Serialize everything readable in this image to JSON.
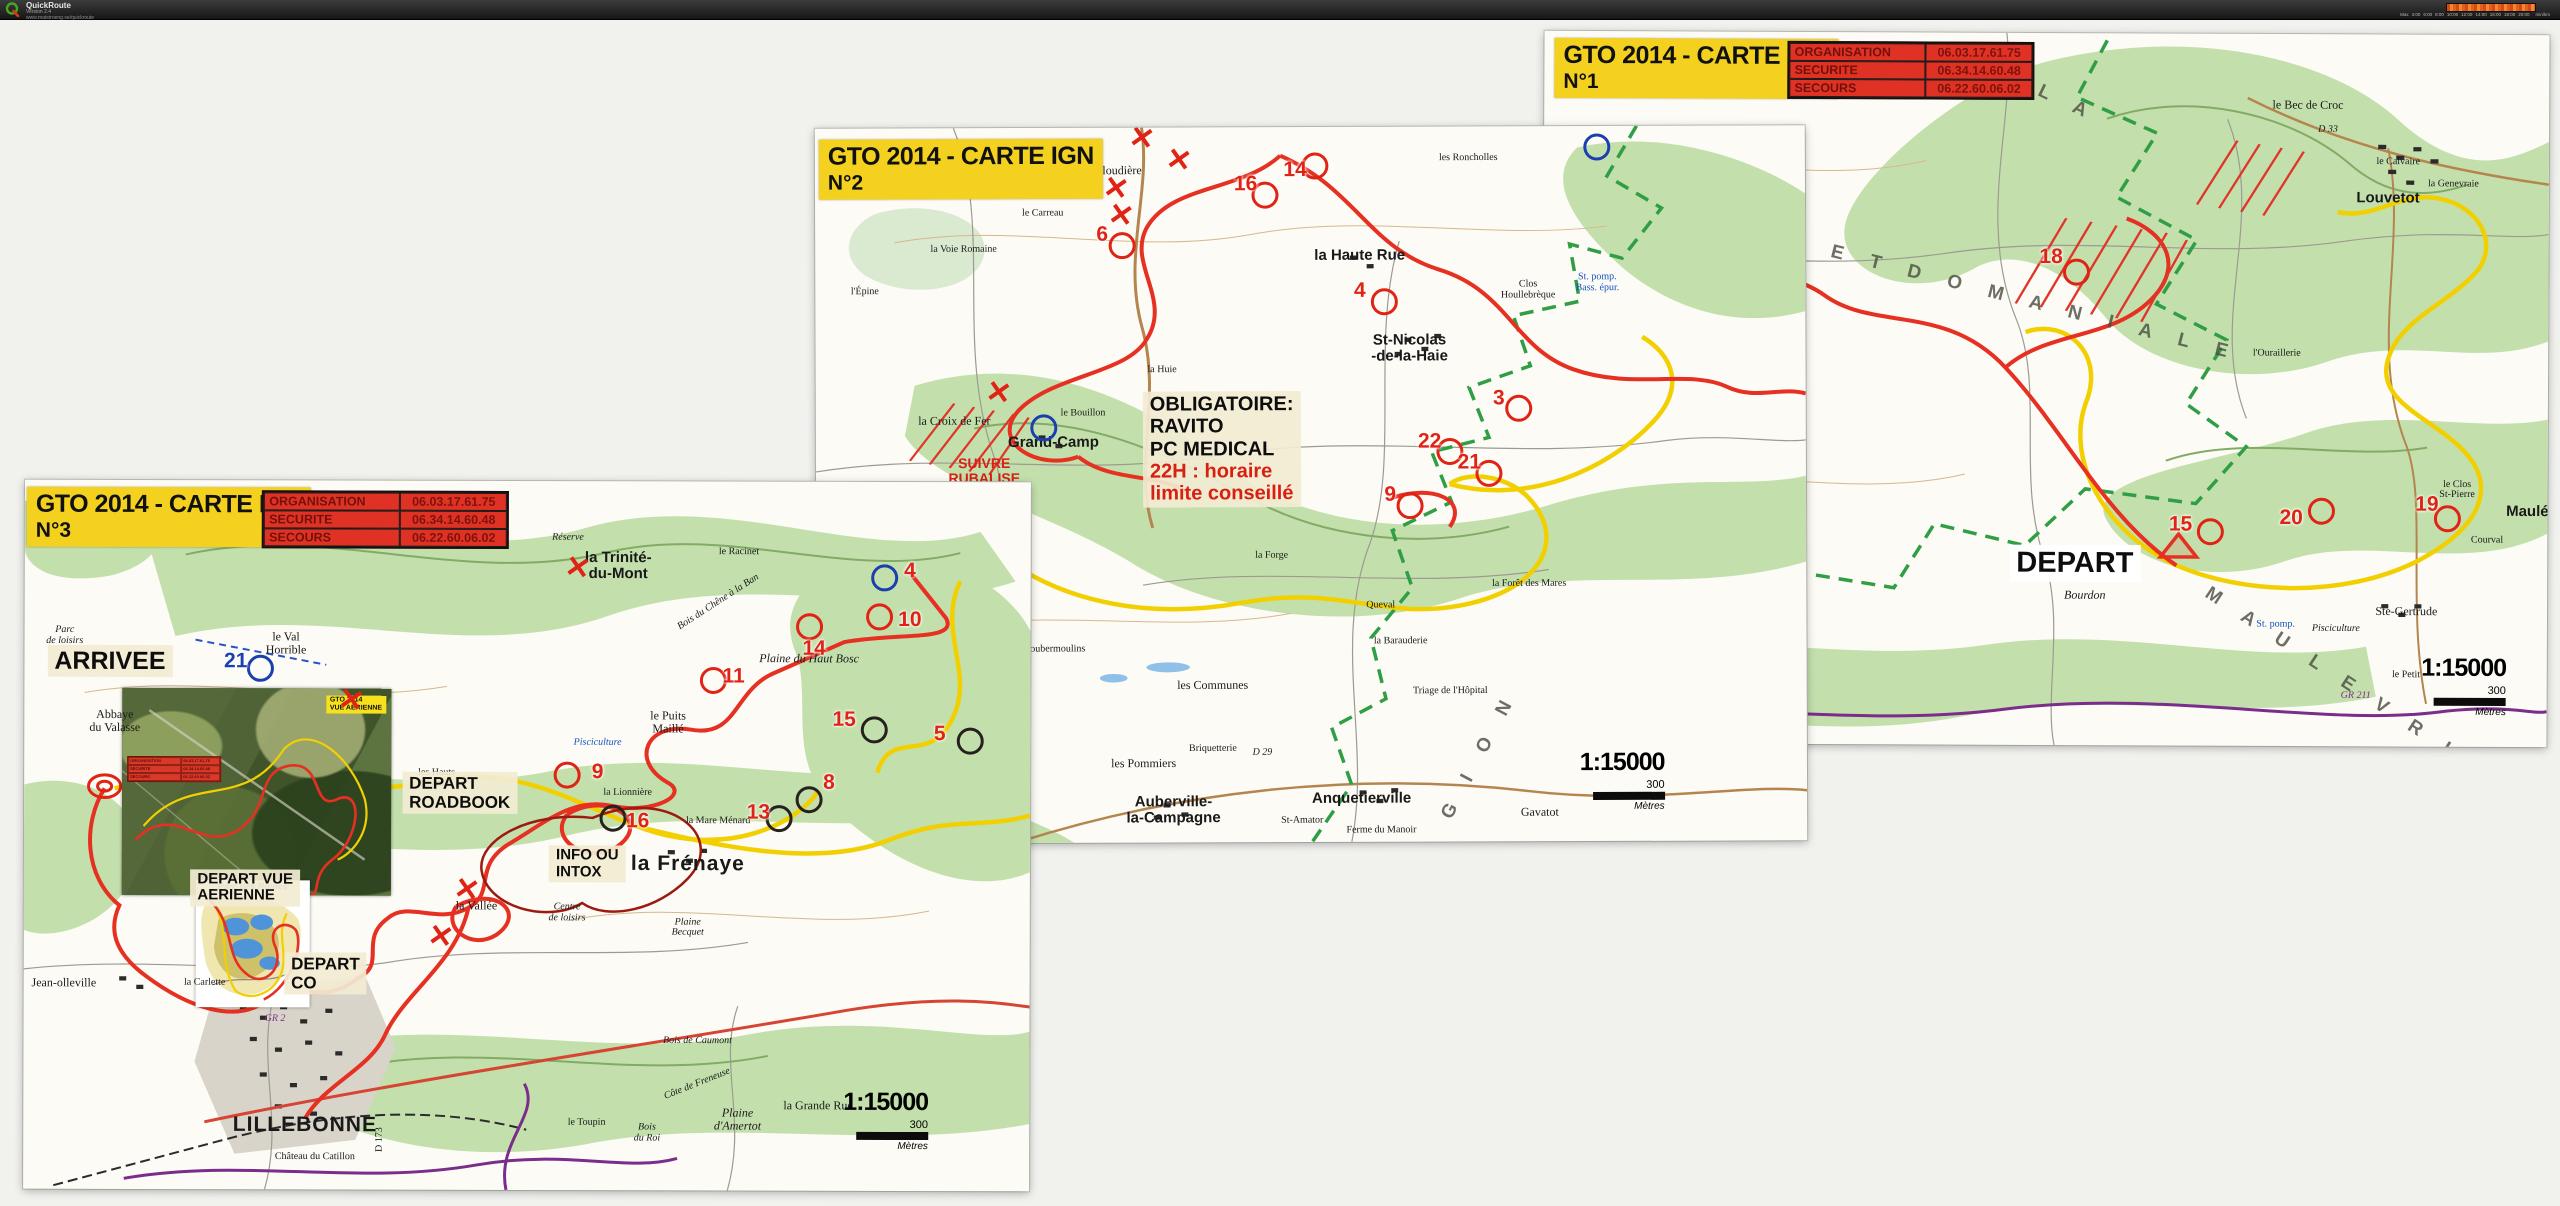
{
  "toolbar": {
    "app_name": "QuickRoute",
    "version": "Version 2.4",
    "url": "www.matstroeng.se/quickroute",
    "legend": {
      "ticks": [
        "Max",
        "4:00",
        "6:00",
        "8:00",
        "10:00",
        "12:00",
        "14:00",
        "16:00",
        "18:00",
        "20:00"
      ],
      "unit": "min/km"
    }
  },
  "colors": {
    "route_red": "#e53022",
    "route_yellow": "#f2cf00",
    "gr_purple": "#7b2d8b",
    "pnr_green": "#2f9e44",
    "title_yellow": "#f4d11f",
    "table_red": "#e03224"
  },
  "sheets": [
    {
      "id": "carte-n1",
      "title": [
        "GTO 2014 - CARTE IGN",
        "N°1"
      ],
      "contacts": [
        [
          "ORGANISATION",
          "06.03.17.61.75"
        ],
        [
          "SECURITE",
          "06.34.14.60.48"
        ],
        [
          "SECOURS",
          "06.22.60.06.02"
        ]
      ],
      "scale": {
        "ratio": "1:15000",
        "value": "300",
        "unit": "Mètres"
      },
      "annotations": [
        {
          "x": 53,
          "y": 74.5,
          "variant": "white",
          "size": 29,
          "lines": [
            {
              "t": "DEPART"
            }
          ]
        }
      ],
      "places": [
        {
          "t": "St-Aubin-\n-de-Crétot",
          "x": 4.5,
          "y": 17,
          "cls": "big"
        },
        {
          "t": "Haut Hôtel",
          "x": 14,
          "y": 23,
          "cls": "tiny"
        },
        {
          "t": "la Cahennerie",
          "x": 8,
          "y": 28,
          "cls": "tiny"
        },
        {
          "t": "le Pommeret",
          "x": 8.5,
          "y": 33,
          "cls": "tiny"
        },
        {
          "t": "St-Gilles-\n-de-Crétot",
          "x": 13,
          "y": 39,
          "cls": "big"
        },
        {
          "t": "Coquetot",
          "x": 20,
          "y": 34,
          "cls": "tiny it"
        },
        {
          "t": "Louvetot",
          "x": 84,
          "y": 23,
          "cls": "big"
        },
        {
          "t": "le Bec de Croc",
          "x": 76,
          "y": 10
        },
        {
          "t": "D 33",
          "x": 78,
          "y": 13.5,
          "cls": "tiny it"
        },
        {
          "t": "le Calvaire",
          "x": 85,
          "y": 18,
          "cls": "tiny"
        },
        {
          "t": "la Genevraie",
          "x": 90.5,
          "y": 21,
          "cls": "tiny"
        },
        {
          "t": "l'Ouraillerie",
          "x": 73,
          "y": 45,
          "cls": "tiny"
        },
        {
          "t": "le Clos\nSt-Pierre",
          "x": 91,
          "y": 64,
          "cls": "tiny"
        },
        {
          "t": "Maulé",
          "x": 98,
          "y": 67,
          "cls": "big"
        },
        {
          "t": "Courval",
          "x": 94,
          "y": 71,
          "cls": "tiny"
        },
        {
          "t": "Ste-Gertrude",
          "x": 86,
          "y": 81
        },
        {
          "t": "Pisciculture",
          "x": 79,
          "y": 83.5,
          "cls": "tiny it"
        },
        {
          "t": "le Petit",
          "x": 86,
          "y": 90,
          "cls": "tiny"
        },
        {
          "t": "GR 211",
          "x": 81,
          "y": 93,
          "cls": "tiny it purple"
        },
        {
          "t": "Bourdon",
          "x": 54,
          "y": 79,
          "cls": "it"
        },
        {
          "t": "St. pomp.",
          "x": 73,
          "y": 83,
          "cls": "tiny blue"
        },
        {
          "t": "F O R E T   D O M A N I A L E",
          "x": 43,
          "y": 36,
          "cls": "spread",
          "rot": 14
        },
        {
          "t": "B O U C L E S",
          "x": 9,
          "y": 56,
          "cls": "spread",
          "rot": 78
        },
        {
          "t": "D E S",
          "x": 16,
          "y": 77,
          "cls": "spread",
          "rot": 55
        },
        {
          "t": "L A",
          "x": 52,
          "y": 10,
          "cls": "spread",
          "rot": 25
        },
        {
          "t": "M A U L E V R I E R",
          "x": 82,
          "y": 93,
          "cls": "spread",
          "rot": 33
        }
      ],
      "controls": [
        {
          "n": "15",
          "tx": 63.5,
          "ty": 69,
          "cx": 66.5,
          "cy": 70
        },
        {
          "n": "18",
          "tx": 50.5,
          "ty": 31.5,
          "cx": 53,
          "cy": 33.5
        },
        {
          "n": "19",
          "tx": 88,
          "ty": 66,
          "cx": 90,
          "cy": 68
        },
        {
          "n": "20",
          "tx": 74.5,
          "ty": 68,
          "cx": 77.5,
          "cy": 67
        },
        {
          "n": "22",
          "tx": 20,
          "ty": 51,
          "cx": 22.5,
          "cy": 52.5
        }
      ],
      "xmarks": []
    },
    {
      "id": "carte-n2",
      "title": [
        "GTO 2014 - CARTE IGN",
        "N°2"
      ],
      "contacts": [],
      "scale": {
        "ratio": "1:15000",
        "value": "300",
        "unit": "Mètres"
      },
      "annotations": [
        {
          "x": 41,
          "y": 45,
          "variant": "beige",
          "size": 20,
          "lines": [
            {
              "t": "OBLIGATOIRE:"
            },
            {
              "t": "RAVITO"
            },
            {
              "t": "PC MEDICAL"
            },
            {
              "t": "22H : horaire",
              "red": true
            },
            {
              "t": "limite conseillé",
              "red": true
            }
          ]
        }
      ],
      "places": [
        {
          "t": "la Gloudière",
          "x": 30,
          "y": 6
        },
        {
          "t": "les Sureaux",
          "x": 10,
          "y": 3.5,
          "cls": "tiny it"
        },
        {
          "t": "le Mare Cardot",
          "x": 21,
          "y": 8.5,
          "cls": "tiny"
        },
        {
          "t": "le Carreau",
          "x": 23,
          "y": 12,
          "cls": "tiny"
        },
        {
          "t": "la Voie Romaine",
          "x": 15,
          "y": 17,
          "cls": "tiny"
        },
        {
          "t": "l'Épine",
          "x": 5,
          "y": 23,
          "cls": "tiny"
        },
        {
          "t": "le Bouillon",
          "x": 27,
          "y": 40,
          "cls": "tiny"
        },
        {
          "t": "Grand-Camp",
          "x": 24,
          "y": 44,
          "cls": "big"
        },
        {
          "t": "la Croix de Fer",
          "x": 14,
          "y": 41
        },
        {
          "t": "SUIVRE\nRUBALISE",
          "x": 17,
          "y": 48,
          "cls": "red"
        },
        {
          "t": "la Huie",
          "x": 35,
          "y": 34,
          "cls": "tiny"
        },
        {
          "t": "St-Nicolas\n-de-la-Haie",
          "x": 60,
          "y": 31,
          "cls": "big"
        },
        {
          "t": "la Haute Rue",
          "x": 55,
          "y": 18,
          "cls": "big"
        },
        {
          "t": "les Roncholles",
          "x": 66,
          "y": 4.5,
          "cls": "tiny"
        },
        {
          "t": "Clos\nHoullebrèque",
          "x": 72,
          "y": 23,
          "cls": "tiny"
        },
        {
          "t": "St. pomp.\nBass. épur.",
          "x": 79,
          "y": 22,
          "cls": "tiny blue"
        },
        {
          "t": "les Communes",
          "x": 40,
          "y": 78
        },
        {
          "t": "la Nouette",
          "x": 17,
          "y": 68,
          "cls": "tiny"
        },
        {
          "t": "Goubermoulins",
          "x": 24,
          "y": 73,
          "cls": "tiny"
        },
        {
          "t": "la Forge",
          "x": 46,
          "y": 60,
          "cls": "tiny"
        },
        {
          "t": "Queval",
          "x": 57,
          "y": 67,
          "cls": "tiny"
        },
        {
          "t": "la Barauderie",
          "x": 59,
          "y": 72,
          "cls": "tiny"
        },
        {
          "t": "Triage de l'Hôpital",
          "x": 64,
          "y": 79,
          "cls": "tiny"
        },
        {
          "t": "la Forêt des Mares",
          "x": 72,
          "y": 64,
          "cls": "tiny"
        },
        {
          "t": "les Pommiers",
          "x": 33,
          "y": 89
        },
        {
          "t": "Auberville-\nla-Campagne",
          "x": 36,
          "y": 95.5,
          "cls": "big"
        },
        {
          "t": "St-Amator",
          "x": 49,
          "y": 97,
          "cls": "tiny"
        },
        {
          "t": "Anquetierville",
          "x": 55,
          "y": 94,
          "cls": "big"
        },
        {
          "t": "Ferme du Manoir",
          "x": 57,
          "y": 98.5,
          "cls": "tiny"
        },
        {
          "t": "Gavatot",
          "x": 73,
          "y": 96
        },
        {
          "t": "Briquetterie",
          "x": 40,
          "y": 87,
          "cls": "tiny"
        },
        {
          "t": "D 29",
          "x": 45,
          "y": 87.5,
          "cls": "tiny it"
        },
        {
          "t": "G I O N",
          "x": 67,
          "y": 88,
          "cls": "spread",
          "rot": -62
        }
      ],
      "controls": [
        {
          "n": "14",
          "tx": 48.5,
          "ty": 6,
          "cx": 50.5,
          "cy": 5.5
        },
        {
          "n": "16",
          "tx": 43.5,
          "ty": 8,
          "cx": 45.5,
          "cy": 9.5
        },
        {
          "n": "6",
          "tx": 29,
          "ty": 15,
          "cx": 31,
          "cy": 16.5
        },
        {
          "n": "4",
          "tx": 55,
          "ty": 23,
          "cx": 57.5,
          "cy": 24.5
        },
        {
          "n": "3",
          "tx": 69,
          "ty": 38,
          "cx": 71,
          "cy": 39.5
        },
        {
          "n": "22",
          "tx": 62,
          "ty": 44,
          "cx": 64,
          "cy": 45.5
        },
        {
          "n": "21",
          "tx": 66,
          "ty": 47,
          "cx": 68,
          "cy": 48.5
        },
        {
          "n": "9",
          "tx": 58,
          "ty": 51.5,
          "cx": 60,
          "cy": 53
        },
        {
          "n": "2",
          "tx": 14,
          "ty": 53,
          "cx": 16,
          "cy": 55
        },
        {
          "n": "",
          "cx": 23,
          "cy": 42,
          "rc": "blue"
        },
        {
          "n": "",
          "cx": 79,
          "cy": 3,
          "rc": "blue"
        }
      ],
      "xmarks": [
        {
          "x": 36.8,
          "y": 4.6
        },
        {
          "x": 33,
          "y": 1.5
        },
        {
          "x": 30.4,
          "y": 8.5
        },
        {
          "x": 30.9,
          "y": 12.3
        },
        {
          "x": 18.5,
          "y": 37
        }
      ]
    },
    {
      "id": "carte-n3",
      "title": [
        "GTO 2014 - CARTE IGN",
        "N°3"
      ],
      "contacts": [
        [
          "ORGANISATION",
          "06.03.17.61.75"
        ],
        [
          "SECURITE",
          "06.34.14.60.48"
        ],
        [
          "SECOURS",
          "06.22.60.06.02"
        ]
      ],
      "scale": {
        "ratio": "1:15000",
        "value": "300",
        "unit": "Mètres"
      },
      "aerial": {
        "label": [
          "GTO 2014",
          "VUE AERIENNE"
        ]
      },
      "omap": {
        "title": "Parc des Ruines"
      },
      "annotations": [
        {
          "x": 8.5,
          "y": 25.5,
          "variant": "beige",
          "size": 25,
          "lines": [
            {
              "t": "ARRIVEE"
            }
          ]
        },
        {
          "x": 43.3,
          "y": 44,
          "variant": "beige",
          "size": 17,
          "lines": [
            {
              "t": "DEPART"
            },
            {
              "t": "ROADBOOK"
            }
          ]
        },
        {
          "x": 56,
          "y": 54,
          "variant": "beige",
          "size": 15,
          "lines": [
            {
              "t": "INFO OU"
            },
            {
              "t": "INTOX"
            }
          ]
        },
        {
          "x": 22,
          "y": 57.5,
          "variant": "beige",
          "size": 15,
          "lines": [
            {
              "t": "DEPART VUE"
            },
            {
              "t": "AERIENNE"
            }
          ]
        },
        {
          "x": 30,
          "y": 69.5,
          "variant": "beige",
          "size": 17,
          "lines": [
            {
              "t": "DEPART"
            },
            {
              "t": "CO"
            }
          ]
        }
      ],
      "places": [
        {
          "t": "la Trinité-\ndu-Mont",
          "x": 59,
          "y": 12,
          "cls": "big"
        },
        {
          "t": "le Racinet",
          "x": 71,
          "y": 10,
          "cls": "tiny"
        },
        {
          "t": "Réserve",
          "x": 54,
          "y": 8,
          "cls": "tiny it"
        },
        {
          "t": "Plaine du Haut Bosc",
          "x": 78,
          "y": 25,
          "cls": "it"
        },
        {
          "t": "Bois du Chêne à la Ban",
          "x": 69,
          "y": 17,
          "cls": "it tiny",
          "rot": -33
        },
        {
          "t": "le Puits\nMaillé",
          "x": 64,
          "y": 34
        },
        {
          "t": "la Lionnière",
          "x": 60,
          "y": 44,
          "cls": "tiny"
        },
        {
          "t": "la Mare Ménard",
          "x": 69,
          "y": 48,
          "cls": "tiny"
        },
        {
          "t": "Pisciculture",
          "x": 57,
          "y": 37,
          "cls": "tiny it blue"
        },
        {
          "t": "Abbaye\ndu Valasse",
          "x": 9,
          "y": 34
        },
        {
          "t": "Parc\nde loisirs",
          "x": 4,
          "y": 22,
          "cls": "tiny it"
        },
        {
          "t": "le Val\nHorrible",
          "x": 26,
          "y": 23
        },
        {
          "t": "les Hauts\nChamps",
          "x": 41,
          "y": 42,
          "cls": "tiny"
        },
        {
          "t": "la Vallée",
          "x": 45,
          "y": 60
        },
        {
          "t": "Centre\nde loisirs",
          "x": 54,
          "y": 61,
          "cls": "tiny it"
        },
        {
          "t": "la Frénaye",
          "x": 66,
          "y": 54,
          "cls": "huge"
        },
        {
          "t": "la Carlette",
          "x": 18,
          "y": 71,
          "cls": "tiny"
        },
        {
          "t": "Jean-olleville",
          "x": 4,
          "y": 71
        },
        {
          "t": "LILLEBONNE",
          "x": 28,
          "y": 91,
          "cls": "huge"
        },
        {
          "t": "Château du Catillon",
          "x": 29,
          "y": 95.5,
          "cls": "tiny"
        },
        {
          "t": "le Toupin",
          "x": 56,
          "y": 90.5,
          "cls": "tiny"
        },
        {
          "t": "Bois\ndu Roi",
          "x": 62,
          "y": 92,
          "cls": "tiny it"
        },
        {
          "t": "Plaine\nd'Amertot",
          "x": 71,
          "y": 90,
          "cls": "it"
        },
        {
          "t": "la Grande Rue",
          "x": 79,
          "y": 88
        },
        {
          "t": "Côte de Freneuse",
          "x": 67,
          "y": 85,
          "cls": "tiny it",
          "rot": -22
        },
        {
          "t": "D 173",
          "x": 35.5,
          "y": 93,
          "cls": "tiny",
          "rot": -90
        },
        {
          "t": "Plaine\nBecquet",
          "x": 66,
          "y": 63,
          "cls": "it tiny"
        },
        {
          "t": "Bois de Caumont",
          "x": 67,
          "y": 79,
          "cls": "it tiny"
        },
        {
          "t": "GR 2",
          "x": 25,
          "y": 76,
          "cls": "tiny purple it"
        }
      ],
      "controls": [
        {
          "n": "4",
          "tx": 88,
          "ty": 12.5,
          "cx": 85.5,
          "cy": 13.5,
          "rc": "blue"
        },
        {
          "n": "10",
          "tx": 88,
          "ty": 19.5,
          "cx": 85,
          "cy": 19
        },
        {
          "n": "14",
          "tx": 78.5,
          "ty": 23.5,
          "cx": 78,
          "cy": 20.5
        },
        {
          "n": "11",
          "tx": 70.5,
          "ty": 27.5,
          "cx": 68.5,
          "cy": 28
        },
        {
          "n": "15",
          "tx": 81.5,
          "ty": 33.5,
          "cx": 84.5,
          "cy": 35,
          "rc": "black"
        },
        {
          "n": "5",
          "tx": 91,
          "ty": 35.5,
          "cx": 94,
          "cy": 36.5,
          "rc": "black"
        },
        {
          "n": "8",
          "tx": 80,
          "ty": 42.5,
          "cx": 78,
          "cy": 44.8,
          "rc": "black"
        },
        {
          "n": "13",
          "tx": 73,
          "ty": 46.7,
          "cx": 75,
          "cy": 47.5,
          "rc": "black"
        },
        {
          "n": "16",
          "tx": 61,
          "ty": 48,
          "cx": 58.5,
          "cy": 47.5,
          "rc": "black"
        },
        {
          "n": "9",
          "tx": 57,
          "ty": 41,
          "cx": 54,
          "cy": 41.5
        },
        {
          "n": "21",
          "tx": 21,
          "ty": 25.5,
          "cx": 23.5,
          "cy": 26.5,
          "rc": "blue",
          "tc": "blue"
        }
      ],
      "xmarks": [
        {
          "x": 32.5,
          "y": 31
        },
        {
          "x": 55,
          "y": 12.3
        },
        {
          "x": 44,
          "y": 57.7
        },
        {
          "x": 41.5,
          "y": 64.3
        }
      ]
    }
  ]
}
